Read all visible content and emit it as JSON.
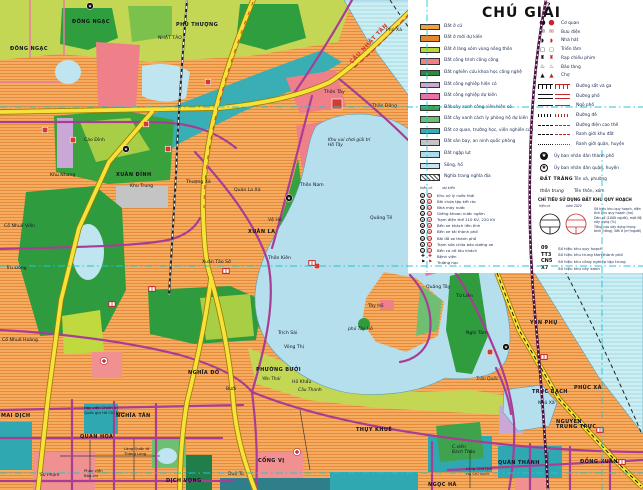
{
  "legend": {
    "title": "CHÚ GIẢI",
    "land_use": [
      {
        "label": "Đất ở cũ",
        "color": "#F2A13F"
      },
      {
        "label": "Đất ở mới dự kiến",
        "color": "#E8862E"
      },
      {
        "label": "Đất ở làng xóm vùng nông thôn",
        "color": "#BCD739"
      },
      {
        "label": "Đất công trình công cộng",
        "color": "#EF8089"
      },
      {
        "label": "Đất nghiên cứu khoa học công nghệ",
        "color": "#2E8B3D"
      },
      {
        "label": "Đất công nghiệp hiện có",
        "color": "#C9A8D8"
      },
      {
        "label": "Đất công nghiệp dự kiến",
        "color": "#E873A8"
      },
      {
        "label": "Đất cây xanh công viên hiện có",
        "color": "#3FA34D"
      },
      {
        "label": "Đất cây xanh cách ly phòng hộ dự kiến",
        "color": "#6FBF73"
      },
      {
        "label": "Đất cơ quan, trường học, viện nghiên cứu",
        "color": "#35ADB5"
      },
      {
        "label": "Đất sân bay, an ninh quốc phòng",
        "color": "#C4C4C4"
      },
      {
        "label": "Đất ngập lụt",
        "color": "#A9DCEC"
      },
      {
        "label": "Sông, hồ",
        "color": "#C2E9F2"
      },
      {
        "label": "Nghĩa trang nghĩa địa",
        "color": "hatch"
      }
    ],
    "poi": [
      {
        "name": "office",
        "glyph": "⬤",
        "label": "Cơ quan"
      },
      {
        "name": "post-office",
        "glyph": "✉",
        "label": "Bưu điện"
      },
      {
        "name": "theater",
        "glyph": "◗",
        "label": "Nhà hát"
      },
      {
        "name": "exhibition",
        "glyph": "▢",
        "label": "Triển lãm"
      },
      {
        "name": "cinema",
        "glyph": "♜",
        "label": "Rạp chiếu phim"
      },
      {
        "name": "museum",
        "glyph": "♨",
        "label": "Bảo tàng"
      },
      {
        "name": "market",
        "glyph": "▲",
        "label": "Chợ"
      }
    ],
    "lines": [
      {
        "label": "Đường sắt và ga",
        "style": "rail"
      },
      {
        "label": "Đường phố",
        "style": "double"
      },
      {
        "label": "Ngõ phố",
        "style": "thin"
      },
      {
        "label": "Đường đê",
        "style": "hatch"
      },
      {
        "label": "Đường điện cao thế",
        "style": "dashdot"
      },
      {
        "label": "Ranh giới khu đất",
        "style": "dash"
      },
      {
        "label": "Ranh giới quận, huyện",
        "style": "dashdotdot"
      }
    ],
    "admin": [
      {
        "symbol": "star-filled",
        "label": "Ủy ban nhân dân thành phố"
      },
      {
        "symbol": "star-outline",
        "label": "Ủy ban nhân dân quận, huyện"
      }
    ],
    "name_samples": [
      {
        "sample": "ĐẤT TRẮNG",
        "kind": "caps",
        "label": "Tên xã, phường"
      },
      {
        "sample": "thôn trung",
        "kind": "ital",
        "label": "Tên thôn, xóm"
      }
    ],
    "indicator": {
      "title": "CHỈ TIÊU SỬ DỤNG ĐẤT KHU QUY HOẠCH",
      "col_left": "hiện có",
      "col_right": "năm 2020",
      "rows": [
        "Số hiệu khu quy hoạch, diện tích khu quy hoạch (ha)",
        "Dân số (1000 người), mật độ xây dựng (%)",
        "Tầng cao xây dựng trung bình (tầng), đất ở (m²/người)"
      ],
      "codes": [
        {
          "code": "09",
          "label": "Số hiệu khu quy hoạch"
        },
        {
          "code": "TT3",
          "label": "Số hiệu khu trung tâm thành phố"
        },
        {
          "code": "CN5",
          "label": "Số hiệu khu công nghiệp tập trung"
        },
        {
          "code": "X7",
          "label": "Số hiệu khu cây xanh"
        }
      ]
    },
    "utility_header": {
      "left": "hiện có",
      "right": "dự kiến"
    },
    "utilities": [
      {
        "glyph": "K",
        "circle": true,
        "label": "Khu xử lý nước thải"
      },
      {
        "glyph": "R",
        "circle": true,
        "label": "Bãi chứa tập kết rác"
      },
      {
        "glyph": "N",
        "circle": true,
        "label": "Nhà máy nước"
      },
      {
        "glyph": "G",
        "circle": true,
        "label": "Giếng khoan nước ngầm"
      },
      {
        "glyph": "T",
        "circle": true,
        "label": "Trạm điện thế 110 KV, 220 KV"
      },
      {
        "glyph": "B",
        "circle": true,
        "label": "Bến xe khách liên tỉnh"
      },
      {
        "glyph": "B",
        "circle": true,
        "label": "Bến xe tải thành phố"
      },
      {
        "glyph": "Đ",
        "circle": true,
        "label": "Bãi đỗ xe thành phố"
      },
      {
        "glyph": "S",
        "circle": true,
        "label": "Trạm sửa chữa bảo dưỡng xe"
      },
      {
        "glyph": "C",
        "circle": true,
        "label": "Bến ca nô tàu khách"
      },
      {
        "glyph": "✚",
        "circle": false,
        "label": "Bệnh viện"
      },
      {
        "glyph": "⚑",
        "circle": false,
        "label": "Trường học"
      }
    ]
  },
  "map": {
    "colors": {
      "residential": "#F6AC60",
      "water": "#B5DFEC",
      "river": "#CDEFF4",
      "park": "#2E9C3E",
      "village_green": "#C3D755",
      "institute_teal": "#35ADB5",
      "public_pink": "#EF8089",
      "industry_magenta": "#E873A8",
      "road_yellow": "#F7E23C",
      "road_purple": "#A83D96",
      "rail_maroon": "#4A1040",
      "utility_cyan": "#21C3D6",
      "marker_red": "#D23B2F"
    },
    "labels": [
      {
        "t": "ĐÔNG NGẠC",
        "x": 72,
        "y": 23,
        "k": "c"
      },
      {
        "t": "ĐÔNG NGẠC",
        "x": 10,
        "y": 50,
        "k": "c"
      },
      {
        "t": "PHÚ THƯỢNG",
        "x": 176,
        "y": 26,
        "k": "c"
      },
      {
        "t": "NHẬT TẢO",
        "x": 158,
        "y": 39,
        "k": "n"
      },
      {
        "t": "Phú Xá",
        "x": 386,
        "y": 31,
        "k": "n"
      },
      {
        "t": "CẦU NHẬT TÂN",
        "x": 352,
        "y": 64,
        "k": "r",
        "r": -47
      },
      {
        "t": "Cáo Đỉnh",
        "x": 84,
        "y": 141,
        "k": "n"
      },
      {
        "t": "Khu Nhang",
        "x": 50,
        "y": 176,
        "k": "n"
      },
      {
        "t": "XUÂN ĐỈNH",
        "x": 116,
        "y": 176,
        "k": "c"
      },
      {
        "t": "Khu Trung",
        "x": 130,
        "y": 187,
        "k": "n"
      },
      {
        "t": "Thượng Xá",
        "x": 186,
        "y": 183,
        "k": "n"
      },
      {
        "t": "Quán La Xá",
        "x": 234,
        "y": 191,
        "k": "n"
      },
      {
        "t": "Thôn Nam",
        "x": 300,
        "y": 186,
        "k": "n"
      },
      {
        "t": "Vệ Hồ",
        "x": 268,
        "y": 221,
        "k": "n"
      },
      {
        "t": "XUÂN LA",
        "x": 248,
        "y": 233,
        "k": "c"
      },
      {
        "t": "Xuân Tảo Sở",
        "x": 202,
        "y": 263,
        "k": "n"
      },
      {
        "t": "Thôn Kiên",
        "x": 268,
        "y": 259,
        "k": "n"
      },
      {
        "t": "Cổ Nhuế Viên",
        "x": 4,
        "y": 227,
        "k": "n"
      },
      {
        "t": "Trù Đông",
        "x": 6,
        "y": 269,
        "k": "n"
      },
      {
        "t": "Cổ Nhuế Hoàng",
        "x": 2,
        "y": 341,
        "k": "n"
      },
      {
        "t": "Thôn Tây",
        "x": 324,
        "y": 93,
        "k": "n"
      },
      {
        "t": "Thôn Đông",
        "x": 372,
        "y": 107,
        "k": "n"
      },
      {
        "t": "Khu vui chơi giải trí|Hồ Tây",
        "x": 328,
        "y": 141,
        "k": "i"
      },
      {
        "t": "Quảng Tế",
        "x": 370,
        "y": 219,
        "k": "n"
      },
      {
        "t": "Tây Hồ",
        "x": 368,
        "y": 307,
        "k": "n"
      },
      {
        "t": "phủ Tây Hồ",
        "x": 348,
        "y": 330,
        "k": "i"
      },
      {
        "t": "Quảng Tây",
        "x": 426,
        "y": 288,
        "k": "n"
      },
      {
        "t": "Tứ Liên",
        "x": 456,
        "y": 297,
        "k": "n"
      },
      {
        "t": "Nghi Tàm",
        "x": 466,
        "y": 334,
        "k": "n"
      },
      {
        "t": "YÊN PHỤ",
        "x": 530,
        "y": 324,
        "k": "c"
      },
      {
        "t": "PHÚC XÁ",
        "x": 574,
        "y": 389,
        "k": "c"
      },
      {
        "t": "Trấn Quốc",
        "x": 476,
        "y": 380,
        "k": "i"
      },
      {
        "t": "TRÚC BẠCH",
        "x": 532,
        "y": 393,
        "k": "c"
      },
      {
        "t": "Ngũ Xã",
        "x": 538,
        "y": 404,
        "k": "n"
      },
      {
        "t": "NGUYỄN|TRUNG TRỰC",
        "x": 556,
        "y": 423,
        "k": "c"
      },
      {
        "t": "QUÁN THÁNH",
        "x": 498,
        "y": 464,
        "k": "c"
      },
      {
        "t": "C.viên|Bách Thảo",
        "x": 452,
        "y": 448,
        "k": "i"
      },
      {
        "t": "Lăng Chủ tịch|Hồ Chí Minh",
        "x": 466,
        "y": 470,
        "k": "t"
      },
      {
        "t": "NGỌC HÀ",
        "x": 428,
        "y": 486,
        "k": "c"
      },
      {
        "t": "ĐỒNG XUÂN",
        "x": 580,
        "y": 463,
        "k": "c"
      },
      {
        "t": "THỤY KHUÊ",
        "x": 356,
        "y": 431,
        "k": "c"
      },
      {
        "t": "PHƯỜNG BƯỞI",
        "x": 256,
        "y": 371,
        "k": "c"
      },
      {
        "t": "Yên Thái",
        "x": 262,
        "y": 380,
        "k": "i"
      },
      {
        "t": "Hồ Khẩu",
        "x": 292,
        "y": 383,
        "k": "n"
      },
      {
        "t": "Cầu Thanh",
        "x": 298,
        "y": 391,
        "k": "i"
      },
      {
        "t": "Bưởi",
        "x": 226,
        "y": 390,
        "k": "n"
      },
      {
        "t": "NGHĨA ĐÔ",
        "x": 188,
        "y": 374,
        "k": "c"
      },
      {
        "t": "Trích Sài",
        "x": 278,
        "y": 334,
        "k": "n"
      },
      {
        "t": "Võng Thị",
        "x": 284,
        "y": 348,
        "k": "n"
      },
      {
        "t": "CỐNG VỊ",
        "x": 258,
        "y": 462,
        "k": "c"
      },
      {
        "t": "Duệ Tú",
        "x": 228,
        "y": 475,
        "k": "n"
      },
      {
        "t": "MAI DỊCH",
        "x": 1,
        "y": 417,
        "k": "c"
      },
      {
        "t": "NGHĨA TÂN",
        "x": 116,
        "y": 417,
        "k": "c"
      },
      {
        "t": "QUAN HOA",
        "x": 80,
        "y": 438,
        "k": "c"
      },
      {
        "t": "Học viện Chính trị|Quốc gia Hồ Chí Minh",
        "x": 84,
        "y": 409,
        "k": "t"
      },
      {
        "t": "Làng Quốc tế|Thăng Long",
        "x": 124,
        "y": 450,
        "k": "t"
      },
      {
        "t": "Sư Phạm",
        "x": 40,
        "y": 476,
        "k": "i"
      },
      {
        "t": "Phân viện|Báo chí",
        "x": 84,
        "y": 472,
        "k": "t"
      },
      {
        "t": "DỊCH VỌNG",
        "x": 166,
        "y": 482,
        "k": "c"
      }
    ],
    "markers": [
      {
        "k": "star",
        "x": 90,
        "y": 6
      },
      {
        "k": "star",
        "x": 126,
        "y": 149
      },
      {
        "k": "star",
        "x": 289,
        "y": 198
      },
      {
        "k": "star",
        "x": 506,
        "y": 347
      },
      {
        "k": "sqbig",
        "x": 337,
        "y": 104
      },
      {
        "k": "sq",
        "x": 45,
        "y": 130
      },
      {
        "k": "sq",
        "x": 73,
        "y": 140
      },
      {
        "k": "sq",
        "x": 146,
        "y": 124
      },
      {
        "k": "sq",
        "x": 168,
        "y": 149
      },
      {
        "k": "sq",
        "x": 317,
        "y": 266
      },
      {
        "k": "sq",
        "x": 490,
        "y": 352
      },
      {
        "k": "sq",
        "x": 208,
        "y": 82
      },
      {
        "k": "school",
        "x": 152,
        "y": 289
      },
      {
        "k": "school",
        "x": 226,
        "y": 271
      },
      {
        "k": "school",
        "x": 312,
        "y": 263
      },
      {
        "k": "school",
        "x": 600,
        "y": 430
      },
      {
        "k": "school",
        "x": 622,
        "y": 462
      },
      {
        "k": "school",
        "x": 544,
        "y": 357
      },
      {
        "k": "school",
        "x": 112,
        "y": 304
      },
      {
        "k": "cross",
        "x": 104,
        "y": 361
      },
      {
        "k": "cross",
        "x": 297,
        "y": 452
      }
    ]
  }
}
